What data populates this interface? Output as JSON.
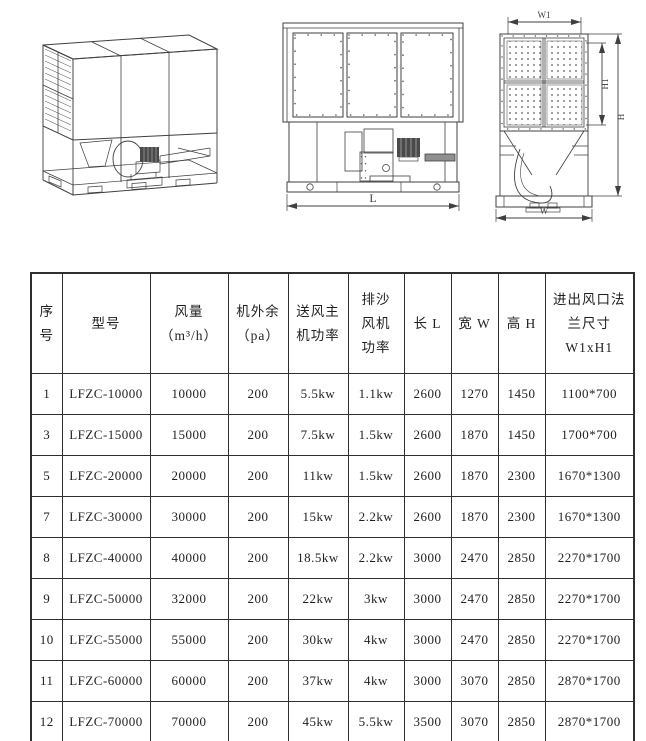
{
  "colors": {
    "background": "#ffffff",
    "line": "#3f3f3f",
    "text": "#1f1f23",
    "table_border": "#2f2f2f",
    "motor_fill": "#4a4a4a",
    "bar_fill": "#8f8f8f"
  },
  "drawings": {
    "front": {
      "length_label": "L"
    },
    "side": {
      "width_top_label": "W1",
      "height_inner_label": "H1",
      "height_label": "H",
      "width_label": "W"
    }
  },
  "table": {
    "headers": [
      {
        "lines": [
          "序",
          "号"
        ]
      },
      {
        "lines": [
          "型号"
        ]
      },
      {
        "lines": [
          "风量",
          "（m³/h）"
        ]
      },
      {
        "lines": [
          "机外余",
          "（pa）"
        ]
      },
      {
        "lines": [
          "送风主",
          "机功率"
        ]
      },
      {
        "lines": [
          "排沙",
          "风机",
          "功率"
        ]
      },
      {
        "lines": [
          "长 L"
        ]
      },
      {
        "lines": [
          "宽 W"
        ]
      },
      {
        "lines": [
          "高 H"
        ]
      },
      {
        "lines": [
          "进出风口法",
          "兰尺寸",
          "W1xH1"
        ]
      }
    ],
    "rows": [
      [
        "1",
        "LFZC-10000",
        "10000",
        "200",
        "5.5kw",
        "1.1kw",
        "2600",
        "1270",
        "1450",
        "1100*700"
      ],
      [
        "3",
        "LFZC-15000",
        "15000",
        "200",
        "7.5kw",
        "1.5kw",
        "2600",
        "1870",
        "1450",
        "1700*700"
      ],
      [
        "5",
        "LFZC-20000",
        "20000",
        "200",
        "11kw",
        "1.5kw",
        "2600",
        "1870",
        "2300",
        "1670*1300"
      ],
      [
        "7",
        "LFZC-30000",
        "30000",
        "200",
        "15kw",
        "2.2kw",
        "2600",
        "1870",
        "2300",
        "1670*1300"
      ],
      [
        "8",
        "LFZC-40000",
        "40000",
        "200",
        "18.5kw",
        "2.2kw",
        "3000",
        "2470",
        "2850",
        "2270*1700"
      ],
      [
        "9",
        "LFZC-50000",
        "32000",
        "200",
        "22kw",
        "3kw",
        "3000",
        "2470",
        "2850",
        "2270*1700"
      ],
      [
        "10",
        "LFZC-55000",
        "55000",
        "200",
        "30kw",
        "4kw",
        "3000",
        "2470",
        "2850",
        "2270*1700"
      ],
      [
        "11",
        "LFZC-60000",
        "60000",
        "200",
        "37kw",
        "4kw",
        "3000",
        "3070",
        "2850",
        "2870*1700"
      ],
      [
        "12",
        "LFZC-70000",
        "70000",
        "200",
        "45kw",
        "5.5kw",
        "3500",
        "3070",
        "2850",
        "2870*1700"
      ]
    ]
  }
}
